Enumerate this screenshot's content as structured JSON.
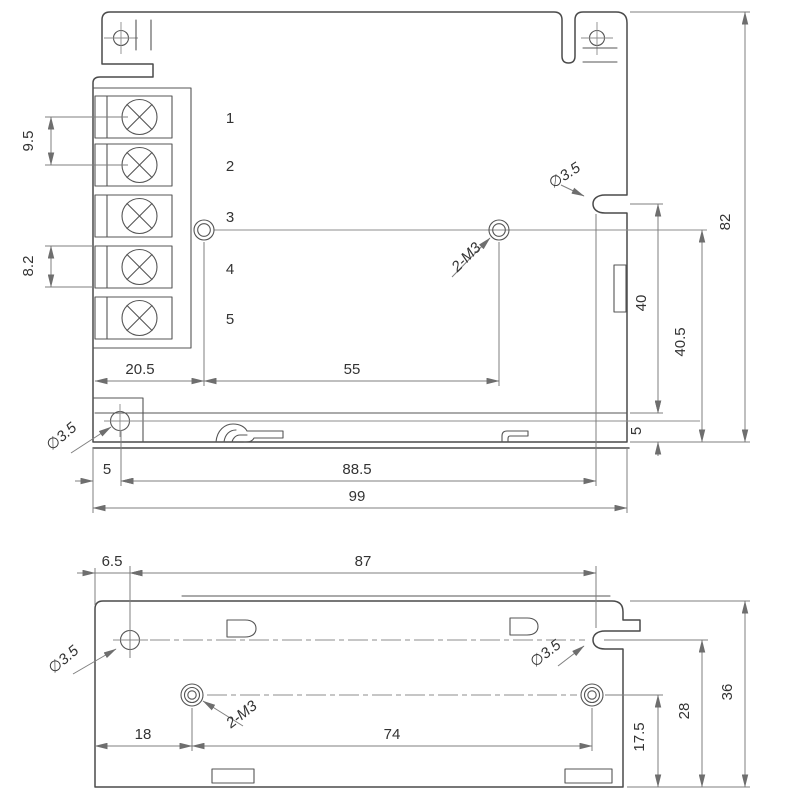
{
  "top_view": {
    "terminals": [
      "1",
      "2",
      "3",
      "4",
      "5"
    ],
    "dims": {
      "pin_pitch_upper": "9.5",
      "pin_pitch_lower": "8.2",
      "block_to_hole": "20.5",
      "hole_spacing": "55",
      "edge_to_flange_hole": "5",
      "flange_hole_to_notch": "88.5",
      "overall_width": "99",
      "notch_to_base": "40",
      "hole_to_base": "40.5",
      "base_lip": "5",
      "overall_depth": "82"
    },
    "labels": {
      "notch_dia": "∅3.5",
      "flange_hole_dia": "∅3.5",
      "thread": "2-M3"
    }
  },
  "bottom_view": {
    "dims": {
      "edge_to_hole": "6.5",
      "hole_to_notch": "87",
      "edge_to_stud": "18",
      "stud_spacing": "74",
      "stud_to_edge": "17.5",
      "notch_to_edge": "28",
      "overall_height": "36"
    },
    "labels": {
      "hole_dia": "∅3.5",
      "notch_dia": "∅3.5",
      "thread": "2-M3"
    }
  }
}
